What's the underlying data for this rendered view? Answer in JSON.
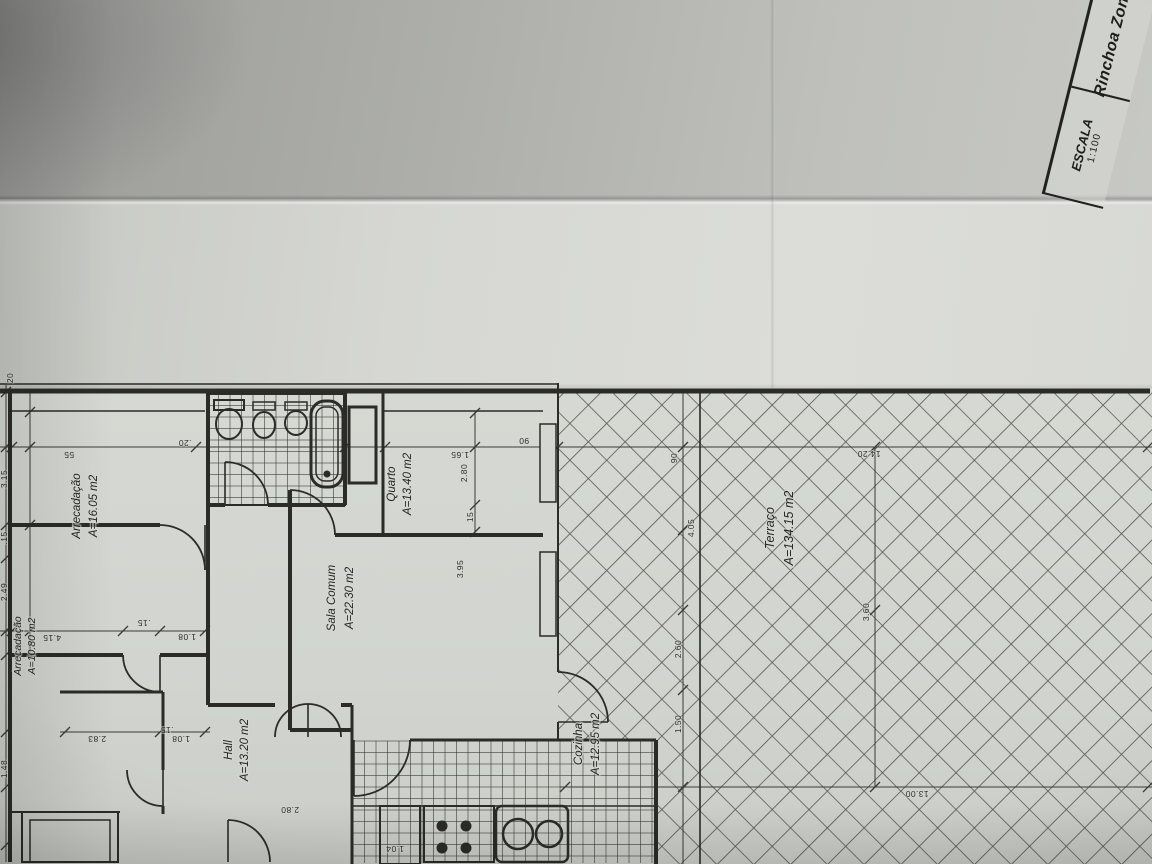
{
  "title_block": {
    "zone_label": "Rinchoa Zona",
    "scale_label": "ESCALA",
    "scale_value": "1:100"
  },
  "colors": {
    "ink": "#2b2b27",
    "dim": "#3a3a36",
    "tile": "#35352f",
    "paper": "#d4d7d1"
  },
  "rooms": [
    {
      "name": "Arrecadação",
      "area": "A=16.05 m2",
      "x": 80,
      "y": 506,
      "gap": 17,
      "fs": 11.5
    },
    {
      "name": "Arrecadação",
      "area": "A=10.80 m2",
      "x": 21,
      "y": 646,
      "gap": 14,
      "fs": 10.5
    },
    {
      "name": "Quarto",
      "area": "A=13.40 m2",
      "x": 395,
      "y": 484,
      "gap": 16,
      "fs": 11.5
    },
    {
      "name": "Sala Comum",
      "area": "A=22.30 m2",
      "x": 335,
      "y": 598,
      "gap": 18,
      "fs": 11.5
    },
    {
      "name": "Hall",
      "area": "A=13.20 m2",
      "x": 232,
      "y": 750,
      "gap": 16,
      "fs": 11.5
    },
    {
      "name": "Cozinha",
      "area": "A=12.95 m2",
      "x": 582,
      "y": 744,
      "gap": 17,
      "fs": 11.5
    },
    {
      "name": "Terraço",
      "area": "A=134.15 m2",
      "x": 774,
      "y": 528,
      "gap": 19,
      "fs": 12.5
    }
  ],
  "dims_rotated": [
    [
      "20",
      13,
      378
    ],
    [
      "3.15",
      7,
      479
    ],
    [
      ".15",
      7,
      538
    ],
    [
      "2.49",
      7,
      592
    ],
    [
      "1.48",
      7,
      769
    ],
    [
      "2.80",
      467,
      473
    ],
    [
      "15",
      473,
      517
    ],
    [
      "3.95",
      463,
      569
    ],
    [
      "90",
      677,
      458
    ],
    [
      "4.05",
      694,
      528
    ],
    [
      "2.60",
      681,
      649
    ],
    [
      "1.50",
      681,
      724
    ],
    [
      "3.60",
      869,
      612
    ]
  ],
  "dims_flipped": [
    [
      "55",
      69,
      452
    ],
    [
      ".20",
      185,
      440
    ],
    [
      "1.65",
      460,
      452
    ],
    [
      "90",
      524,
      438
    ],
    [
      "14.20",
      869,
      451
    ],
    [
      "13.00",
      917,
      791
    ],
    [
      "4.15",
      52,
      635
    ],
    [
      "1.08",
      187,
      634
    ],
    [
      "2.83",
      97,
      736
    ],
    [
      "1.08",
      181,
      736
    ],
    [
      ".15",
      144,
      620
    ],
    [
      ".15",
      167,
      727
    ],
    [
      "2.80",
      290,
      807
    ],
    [
      "1.04",
      395,
      846
    ]
  ],
  "drawing": {
    "walls": [
      [
        0,
        391,
        1150,
        391,
        5
      ],
      [
        10,
        391,
        10,
        862,
        4
      ],
      [
        208,
        391,
        208,
        705,
        4
      ],
      [
        345,
        391,
        345,
        505,
        4
      ],
      [
        383,
        391,
        383,
        535,
        3
      ],
      [
        290,
        490,
        290,
        730,
        4
      ],
      [
        208,
        505,
        225,
        505,
        4
      ],
      [
        268,
        505,
        345,
        505,
        4
      ],
      [
        10,
        525,
        160,
        525,
        4
      ],
      [
        335,
        535,
        543,
        535,
        4
      ],
      [
        10,
        655,
        123,
        655,
        4
      ],
      [
        160,
        655,
        208,
        655,
        4
      ],
      [
        60,
        692,
        163,
        692,
        3
      ],
      [
        163,
        692,
        163,
        770,
        3
      ],
      [
        163,
        806,
        163,
        814,
        3
      ],
      [
        10,
        812,
        120,
        812,
        2
      ],
      [
        208,
        705,
        275,
        705,
        4
      ],
      [
        341,
        705,
        352,
        705,
        4
      ],
      [
        352,
        705,
        352,
        864,
        3
      ],
      [
        290,
        730,
        352,
        730,
        4
      ],
      [
        410,
        740,
        560,
        740,
        3
      ],
      [
        560,
        740,
        656,
        740,
        3
      ],
      [
        656,
        740,
        656,
        864,
        4
      ],
      [
        558,
        383,
        558,
        672,
        2
      ],
      [
        558,
        722,
        558,
        740,
        2
      ]
    ],
    "thin_lines": [
      [
        0,
        384,
        558,
        384
      ],
      [
        12,
        411,
        205,
        411
      ],
      [
        383,
        411,
        543,
        411
      ],
      [
        700,
        391,
        700,
        864
      ],
      [
        205,
        525,
        205,
        570
      ],
      [
        225,
        505,
        225,
        462
      ],
      [
        160,
        655,
        160,
        692
      ],
      [
        163,
        770,
        163,
        806
      ],
      [
        228,
        820,
        228,
        862
      ],
      [
        558,
        722,
        608,
        722
      ],
      [
        308,
        704,
        308,
        737
      ],
      [
        354,
        740,
        354,
        796
      ],
      [
        352,
        806,
        656,
        806
      ],
      [
        548,
        424,
        548,
        502
      ],
      [
        548,
        552,
        548,
        634
      ]
    ],
    "dim_lines": [
      [
        0,
        447,
        1152,
        447
      ],
      [
        6,
        385,
        6,
        862
      ],
      [
        30,
        391,
        30,
        655
      ],
      [
        0,
        631,
        210,
        631
      ],
      [
        60,
        732,
        210,
        732
      ],
      [
        475,
        412,
        475,
        535
      ],
      [
        560,
        787,
        1152,
        787
      ],
      [
        683,
        391,
        683,
        864
      ],
      [
        875,
        447,
        875,
        787
      ]
    ],
    "ticks": [
      [
        12,
        447
      ],
      [
        196,
        447
      ],
      [
        345,
        447
      ],
      [
        385,
        447
      ],
      [
        475,
        447
      ],
      [
        545,
        447
      ],
      [
        558,
        447
      ],
      [
        683,
        447
      ],
      [
        875,
        447
      ],
      [
        1148,
        447
      ],
      [
        12,
        631
      ],
      [
        123,
        631
      ],
      [
        160,
        631
      ],
      [
        205,
        631
      ],
      [
        65,
        732
      ],
      [
        160,
        732
      ],
      [
        205,
        732
      ],
      [
        565,
        787
      ],
      [
        683,
        787
      ],
      [
        875,
        787
      ],
      [
        1148,
        787
      ],
      [
        6,
        392
      ],
      [
        6,
        447
      ],
      [
        6,
        525
      ],
      [
        6,
        558
      ],
      [
        6,
        631
      ],
      [
        6,
        655
      ],
      [
        6,
        732
      ],
      [
        6,
        787
      ],
      [
        6,
        845
      ],
      [
        475,
        413
      ],
      [
        475,
        505
      ],
      [
        475,
        532
      ],
      [
        683,
        530
      ],
      [
        683,
        610
      ],
      [
        683,
        690
      ],
      [
        875,
        610
      ],
      [
        30,
        412
      ],
      [
        30,
        447
      ],
      [
        30,
        525
      ],
      [
        30,
        631
      ]
    ],
    "door_arcs": [
      "M160,525 A45,45 0 0 1 205,570",
      "M225,462 A43,43 0 0 1 268,505",
      "M290,490 A45,45 0 0 1 335,535",
      "M123,655 A37,37 0 0 0 160,692",
      "M127,770 A36,36 0 0 0 163,806",
      "M228,820 A42,42 0 0 1 270,862",
      "M558,672 A50,50 0 0 1 608,722",
      "M275,737 A33,33 0 0 1 308,704",
      "M341,737 A33,33 0 0 0 308,704",
      "M410,740 A56,56 0 0 1 354,796"
    ],
    "rects": [
      [
        207,
        394,
        138,
        111,
        2,
        0
      ],
      [
        22,
        812,
        96,
        50,
        2,
        0
      ],
      [
        30,
        820,
        80,
        42,
        1.5,
        0
      ],
      [
        311,
        401,
        32,
        86,
        3,
        14
      ],
      [
        316,
        407,
        22,
        74,
        1.5,
        9
      ],
      [
        349,
        407,
        27,
        76,
        3,
        0
      ],
      [
        424,
        806,
        70,
        56,
        2,
        0
      ],
      [
        496,
        806,
        72,
        56,
        2.5,
        6
      ],
      [
        380,
        806,
        40,
        58,
        2,
        0
      ],
      [
        214,
        400,
        30,
        10,
        2,
        0
      ],
      [
        253,
        402,
        22,
        8,
        1.5,
        0
      ],
      [
        285,
        402,
        22,
        8,
        1.5,
        0
      ]
    ],
    "windows": [
      [
        540,
        424,
        16,
        78
      ],
      [
        540,
        552,
        16,
        84
      ]
    ],
    "ellipses": [
      [
        229,
        424,
        13,
        15,
        2
      ],
      [
        264,
        425,
        11,
        13,
        2
      ],
      [
        296,
        423,
        11,
        12,
        2
      ]
    ],
    "circles": [
      [
        442,
        826,
        5.5,
        0,
        1
      ],
      [
        466,
        826,
        5.5,
        0,
        1
      ],
      [
        442,
        848,
        5.5,
        0,
        1
      ],
      [
        466,
        848,
        5.5,
        0,
        1
      ],
      [
        518,
        834,
        15,
        2.5,
        0
      ],
      [
        549,
        834,
        13,
        2.5,
        0
      ],
      [
        327,
        474,
        3.5,
        0,
        1
      ]
    ],
    "tile_regions": [
      {
        "x": 207,
        "y": 394,
        "w": 138,
        "h": 111,
        "c": 11.5
      },
      {
        "x": 353,
        "y": 741,
        "w": 303,
        "h": 122,
        "c": 11.5
      }
    ],
    "hatch_regions": [
      [
        558,
        391,
        594,
        349
      ],
      [
        656,
        740,
        496,
        124
      ]
    ]
  }
}
